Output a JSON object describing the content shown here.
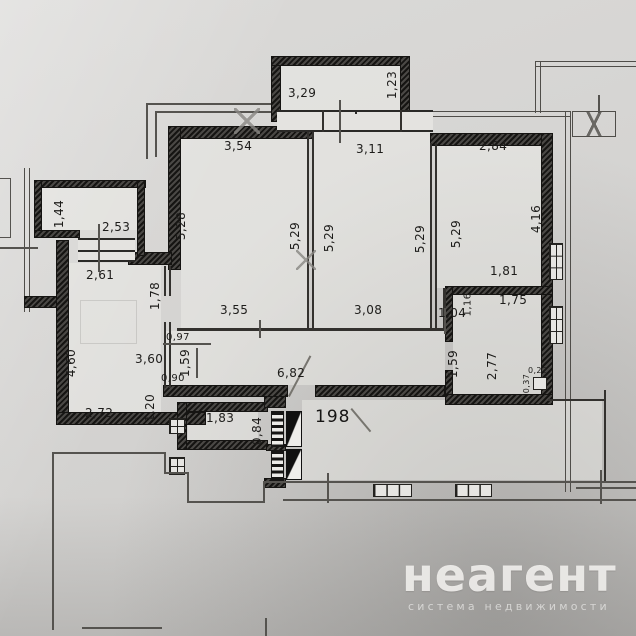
{
  "watermark": {
    "brand": "неагент",
    "tagline": "система недвижимости"
  },
  "apartment": {
    "number": "198"
  },
  "dims": {
    "top_balcony_width": "3,29",
    "top_balcony_depth": "1,23",
    "room1_width": "3,54",
    "room2_width": "3,11",
    "room3_width": "2,84",
    "room1_height_left": "5,28",
    "room1_height_right": "5,29",
    "room2_height_left": "5,29",
    "room2_height_right": "5,29",
    "room3_height_left": "5,29",
    "room3_height_right": "4,16",
    "left_balcony_depth": "1,44",
    "kitchen_window_width": "2,53",
    "kitchen_top_width": "2,61",
    "hall_upper_height": "1,78",
    "room1_bottom_width": "3,55",
    "room2_bottom_width": "3,08",
    "wall_seg_104": "1,04",
    "wall_seg_116": "1,16",
    "bathroom_outer_width": "1,81",
    "bathroom_width": "1,75",
    "bathroom_door_height": "1,59",
    "bathroom_height": "2,77",
    "bathroom_niche_depth": "0,37",
    "bathroom_niche_width": "0,22",
    "hall_seg_097": "0,97",
    "hall_door_159": "1,59",
    "hall_width": "3,60",
    "hall_seg_090": "0,90",
    "kitchen_height": "4,60",
    "kitchen_width": "2,72",
    "kitchen_door_seg": "1,20",
    "corridor_width": "6,82",
    "closet_width": "1,83",
    "closet_door": "0,84"
  }
}
